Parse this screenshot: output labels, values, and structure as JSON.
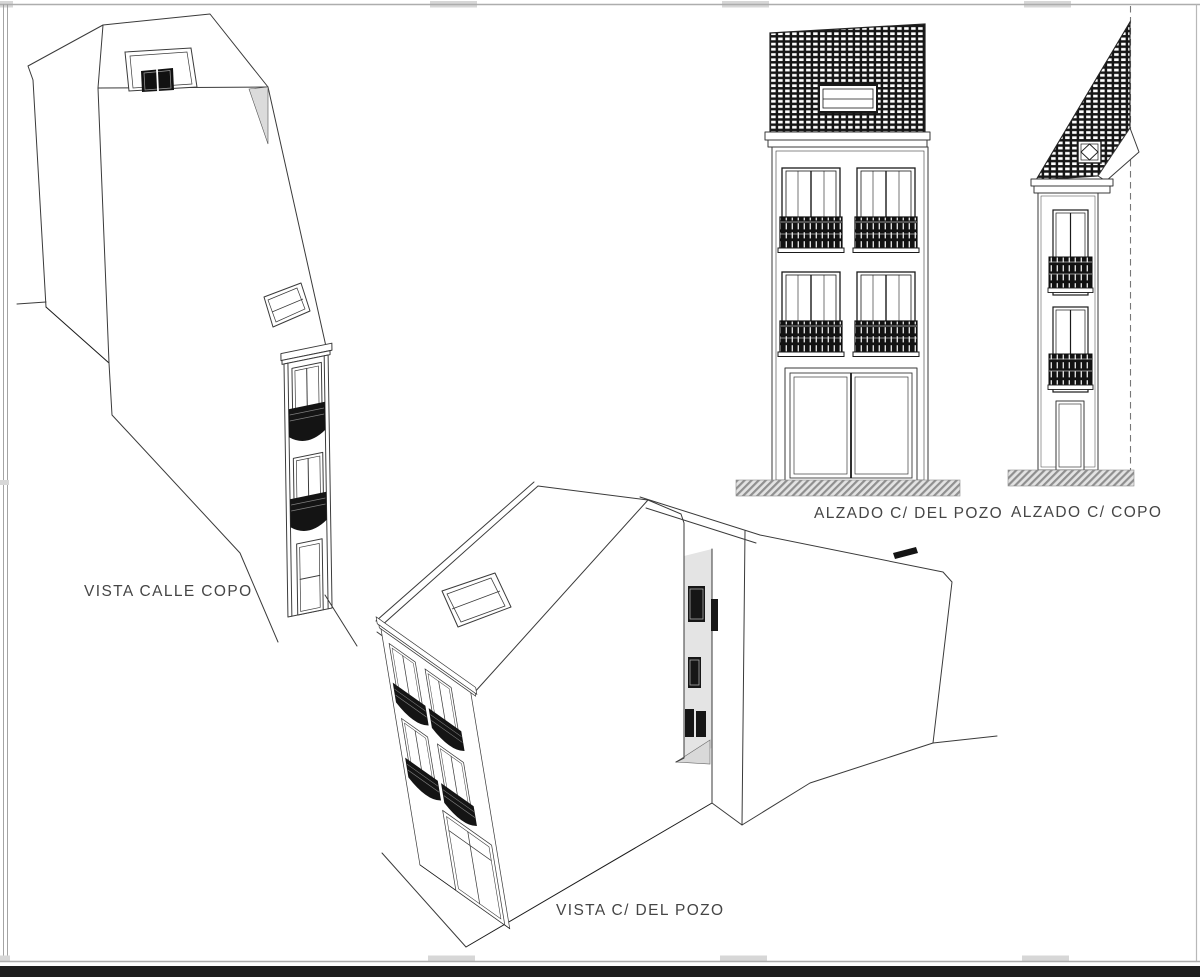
{
  "page": {
    "background": "#ffffff",
    "frame_color": "#adadad",
    "notch_color": "#d7d7d7",
    "bottom_bar_color": "#1e1e1e",
    "line_color": "#3a3a3a",
    "shading_color": "#dcdcdc"
  },
  "views": [
    {
      "id": "vista-calle-copo",
      "label": "VISTA CALLE COPO",
      "type": "3d-perspective-view"
    },
    {
      "id": "alzado-del-pozo",
      "label": "ALZADO C/ DEL POZO",
      "type": "front-elevation"
    },
    {
      "id": "alzado-copo",
      "label": "ALZADO C/ COPO",
      "type": "side-elevation"
    },
    {
      "id": "vista-del-pozo",
      "label": "VISTA C/ DEL POZO",
      "type": "3d-perspective-view"
    }
  ]
}
